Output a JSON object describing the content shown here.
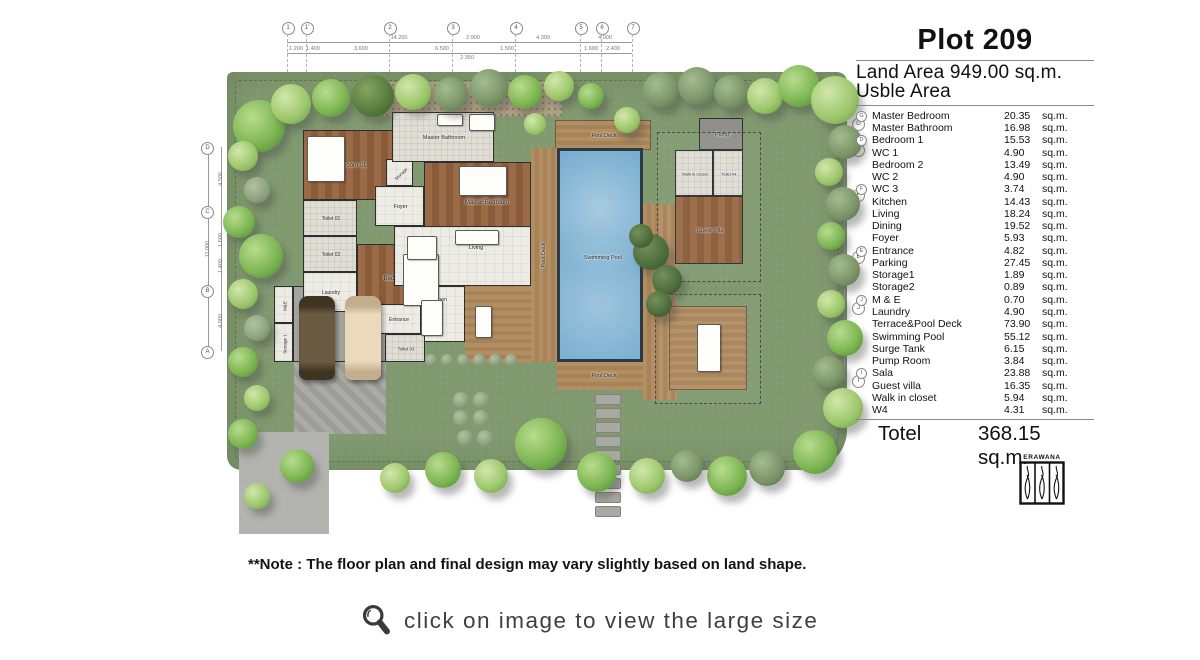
{
  "header": {
    "title": "Plot 209",
    "land_area": "Land Area 949.00 sq.m.",
    "usable_area": "Usble Area"
  },
  "table": {
    "unit": "sq.m.",
    "rows": [
      {
        "marker": "G",
        "name": "Master Bedroom",
        "value": "20.35"
      },
      {
        "name": "Master Bathroom",
        "value": "16.98"
      },
      {
        "marker": "D",
        "name": "Bedroom 1",
        "value": "15.53"
      },
      {
        "name": "WC 1",
        "value": "4.90"
      },
      {
        "name": "Bedroom 2",
        "value": "13.49"
      },
      {
        "name": "WC 2",
        "value": "4.90"
      },
      {
        "marker": "F",
        "name": "WC 3",
        "value": "3.74"
      },
      {
        "name": "Kitchen",
        "value": "14.43"
      },
      {
        "name": "Living",
        "value": "18.24"
      },
      {
        "name": "Dining",
        "value": "19.52"
      },
      {
        "name": "Foyer",
        "value": "5.93"
      },
      {
        "marker": "E",
        "name": "Entrance",
        "value": "4.82"
      },
      {
        "name": "Parking",
        "value": "27.45"
      },
      {
        "name": "Storage1",
        "value": "1.89"
      },
      {
        "name": "Storage2",
        "value": "0.89"
      },
      {
        "marker": "J",
        "name": "M & E",
        "value": "0.70"
      },
      {
        "name": "Laundry",
        "value": "4.90"
      },
      {
        "name": "Terrace&Pool Deck",
        "value": "73.90"
      },
      {
        "name": "Swimming Pool",
        "value": "55.12"
      },
      {
        "name": "Surge Tank",
        "value": "6.15"
      },
      {
        "name": "Pump Room",
        "value": "3.84"
      },
      {
        "marker": "I",
        "name": "Sala",
        "value": "23.88"
      },
      {
        "name": "Guest villa",
        "value": "16.35"
      },
      {
        "name": "Walk in closet",
        "value": "5.94"
      },
      {
        "name": "W4",
        "value": "4.31"
      }
    ]
  },
  "total": {
    "label": "Totel",
    "value": "368.15",
    "unit": "sq.m."
  },
  "logo": {
    "brand": "ERAWANA"
  },
  "note": "**Note : The floor plan and final design may vary slightly based on land shape.",
  "caption": {
    "icon": "magnifier-icon",
    "text": "click on image to view the large size"
  },
  "plan": {
    "grid": {
      "top": {
        "markers": [
          {
            "t": "1",
            "x": 88
          },
          {
            "t": "1'",
            "x": 107
          },
          {
            "t": "2",
            "x": 190
          },
          {
            "t": "3",
            "x": 253
          },
          {
            "t": "4",
            "x": 316
          },
          {
            "t": "5",
            "x": 381
          },
          {
            "t": "6",
            "x": 402
          },
          {
            "t": "7",
            "x": 433
          }
        ],
        "dims": [
          {
            "t": "14.200",
            "x": 200,
            "y": 30
          },
          {
            "t": "2.900",
            "x": 274,
            "y": 30
          },
          {
            "t": "4.300",
            "x": 344,
            "y": 30
          },
          {
            "t": "4.000",
            "x": 406,
            "y": 30
          },
          {
            "t": "1.200",
            "x": 97,
            "y": 41
          },
          {
            "t": "1.400",
            "x": 114,
            "y": 41
          },
          {
            "t": "3.600",
            "x": 162,
            "y": 41
          },
          {
            "t": "6.500",
            "x": 243,
            "y": 41
          },
          {
            "t": "1.500",
            "x": 308,
            "y": 41
          },
          {
            "t": "1.600",
            "x": 392,
            "y": 41
          },
          {
            "t": "2.400",
            "x": 414,
            "y": 41
          },
          {
            "t": "2.350",
            "x": 268,
            "y": 50
          }
        ]
      },
      "left": {
        "markers": [
          {
            "t": "D",
            "y": 139
          },
          {
            "t": "C",
            "y": 203
          },
          {
            "t": "B",
            "y": 282
          },
          {
            "t": "A",
            "y": 343
          }
        ],
        "dims": [
          {
            "t": "4.500",
            "x": 22,
            "y": 171,
            "r": -90
          },
          {
            "t": "1.600",
            "x": 22,
            "y": 232,
            "r": -90
          },
          {
            "t": "1.400",
            "x": 22,
            "y": 258,
            "r": -90
          },
          {
            "t": "4.000",
            "x": 22,
            "y": 313,
            "r": -90
          },
          {
            "t": "11.000",
            "x": 9,
            "y": 241,
            "r": -90
          }
        ]
      },
      "right": {
        "markers": [
          {
            "t": "G",
            "y": 115
          },
          {
            "t": "D",
            "y": 141
          },
          {
            "t": "F",
            "y": 186
          },
          {
            "t": "E",
            "y": 248
          },
          {
            "t": "J",
            "y": 299
          },
          {
            "t": "I",
            "y": 372
          }
        ],
        "dims": [
          {
            "t": "1.710",
            "x": 645,
            "y": 128,
            "r": -90
          },
          {
            "t": "2.900",
            "x": 645,
            "y": 163,
            "r": -90
          },
          {
            "t": "4.700",
            "x": 645,
            "y": 215,
            "r": -90
          },
          {
            "t": "3.100",
            "x": 645,
            "y": 273,
            "r": -90
          },
          {
            "t": "5.000",
            "x": 645,
            "y": 336,
            "r": -90
          }
        ]
      }
    },
    "rooms": [
      {
        "n": "gravel-court",
        "f": "gravel",
        "x": 185,
        "y": 74,
        "w": 178,
        "h": 34
      },
      {
        "n": "drive-upper",
        "f": "driveh",
        "x": 95,
        "y": 352,
        "w": 92,
        "h": 74
      },
      {
        "n": "drive-lower",
        "f": "drive",
        "x": 40,
        "y": 424,
        "w": 90,
        "h": 102
      },
      {
        "n": "terrace",
        "f": "deckh",
        "x": 266,
        "y": 278,
        "w": 66,
        "h": 77
      },
      {
        "n": "carpark",
        "f": "gray",
        "x": 94,
        "y": 278,
        "w": 98,
        "h": 76,
        "label": "Car Park",
        "wall": 1,
        "lx": 49,
        "ly": 11,
        "fs": 6
      },
      {
        "n": "mne",
        "f": "tile",
        "x": 75,
        "y": 278,
        "w": 19,
        "h": 37,
        "label": "M&E",
        "wall": 1,
        "rot": -90,
        "fs": 4.5
      },
      {
        "n": "storage-1",
        "f": "tile",
        "x": 75,
        "y": 315,
        "w": 19,
        "h": 39,
        "label": "Storage 1",
        "wall": 1,
        "rot": -90,
        "fs": 4.5
      },
      {
        "n": "bedroom-01",
        "f": "wood",
        "x": 104,
        "y": 122,
        "w": 92,
        "h": 70,
        "label": "Bedroom 01",
        "wall": 1
      },
      {
        "n": "toilet-01",
        "f": "bath",
        "x": 104,
        "y": 192,
        "w": 54,
        "h": 36,
        "label": "Toilet 01",
        "wall": 1,
        "fs": 5
      },
      {
        "n": "toilet-02",
        "f": "bath",
        "x": 104,
        "y": 228,
        "w": 54,
        "h": 36,
        "label": "Toilet 02",
        "wall": 1,
        "fs": 5
      },
      {
        "n": "laundry",
        "f": "tile",
        "x": 104,
        "y": 264,
        "w": 54,
        "h": 40,
        "label": "Laundry",
        "wall": 1,
        "fs": 5
      },
      {
        "n": "bedroom-02",
        "f": "wood",
        "x": 158,
        "y": 236,
        "w": 84,
        "h": 68,
        "label": "Bedroom 02",
        "wall": 1
      },
      {
        "n": "foyer",
        "f": "tile",
        "x": 176,
        "y": 178,
        "w": 49,
        "h": 40,
        "label": "Foyer",
        "wall": 1,
        "fs": 5.5
      },
      {
        "n": "storage-sm",
        "f": "tile",
        "x": 187,
        "y": 151,
        "w": 27,
        "h": 27,
        "label": "Storage",
        "wall": 1,
        "rot": -45,
        "fs": 4.5
      },
      {
        "n": "master-bathroom",
        "f": "bath",
        "x": 193,
        "y": 104,
        "w": 102,
        "h": 50,
        "label": "Master Bathroom",
        "wall": 1,
        "fs": 5.5
      },
      {
        "n": "master-bedroom",
        "f": "wood",
        "x": 225,
        "y": 154,
        "w": 107,
        "h": 92,
        "label": "Master Bedroom",
        "wall": 1,
        "lx": 62,
        "ly": 40
      },
      {
        "n": "living-dining-hall",
        "f": "tile",
        "x": 195,
        "y": 218,
        "w": 137,
        "h": 60,
        "wall": 1
      },
      {
        "n": "kitchen",
        "f": "tile",
        "x": 210,
        "y": 278,
        "w": 56,
        "h": 56,
        "label": "Kitchen",
        "wall": 1,
        "fs": 5.5,
        "ly": 13
      },
      {
        "n": "entrance",
        "f": "tile",
        "x": 176,
        "y": 296,
        "w": 46,
        "h": 30,
        "label": "Entrance",
        "wall": 1,
        "fs": 5
      },
      {
        "n": "toilet-03",
        "f": "bath",
        "x": 186,
        "y": 326,
        "w": 40,
        "h": 28,
        "label": "Toilet 03",
        "wall": 1,
        "fs": 4.5
      },
      {
        "n": "pool-deck-top",
        "f": "deckh",
        "x": 356,
        "y": 112,
        "w": 96,
        "h": 30,
        "label": "Pool Deck",
        "fs": 5.5,
        "border": 1
      },
      {
        "n": "pool-deck-left",
        "f": "deckv",
        "x": 332,
        "y": 140,
        "w": 26,
        "h": 214,
        "label": "Pool Deck",
        "rot": -90,
        "fs": 5.5
      },
      {
        "n": "swimming-pool",
        "f": "pool",
        "x": 358,
        "y": 140,
        "w": 86,
        "h": 214,
        "label": "Swimming Pool",
        "fs": 5.5
      },
      {
        "n": "pool-deck-bottom",
        "f": "deckh",
        "x": 358,
        "y": 354,
        "w": 94,
        "h": 28,
        "label": "Pool Deck",
        "fs": 5.5
      },
      {
        "n": "pool-deck-right",
        "f": "deckv",
        "x": 444,
        "y": 196,
        "w": 34,
        "h": 196,
        "label": "Pool Deck",
        "rot": -90,
        "fs": 5.5
      },
      {
        "n": "pump-room",
        "f": "gray2",
        "x": 500,
        "y": 110,
        "w": 44,
        "h": 32,
        "label": "Pump",
        "wall": 1,
        "fs": 5.5
      },
      {
        "n": "walk-in-closet",
        "f": "bath",
        "x": 476,
        "y": 142,
        "w": 38,
        "h": 46,
        "label": "Walk in Closet",
        "wall": 1,
        "fs": 4
      },
      {
        "n": "toilet-04",
        "f": "bath",
        "x": 514,
        "y": 142,
        "w": 30,
        "h": 46,
        "label": "Toilet 04",
        "wall": 1,
        "fs": 4
      },
      {
        "n": "guest-villa",
        "f": "wood",
        "x": 476,
        "y": 188,
        "w": 68,
        "h": 68,
        "label": "Guest Villa",
        "wall": 1,
        "fs": 5.5
      },
      {
        "n": "sala",
        "f": "deckh",
        "x": 470,
        "y": 298,
        "w": 78,
        "h": 84,
        "label": "Sala",
        "fs": 5.5,
        "ly": 56,
        "border": 1
      }
    ],
    "free_labels": [
      {
        "t": "Dining",
        "x": 222,
        "y": 240
      },
      {
        "t": "Living",
        "x": 277,
        "y": 240
      }
    ],
    "roofs": [
      {
        "x": 458,
        "y": 124,
        "w": 102,
        "h": 148
      },
      {
        "x": 456,
        "y": 286,
        "w": 104,
        "h": 108
      }
    ],
    "furniture": [
      {
        "x": 108,
        "y": 128,
        "w": 36,
        "h": 44
      },
      {
        "x": 204,
        "y": 246,
        "w": 34,
        "h": 50
      },
      {
        "x": 260,
        "y": 158,
        "w": 46,
        "h": 28
      },
      {
        "x": 208,
        "y": 228,
        "w": 28,
        "h": 22
      },
      {
        "x": 256,
        "y": 222,
        "w": 42,
        "h": 13
      },
      {
        "x": 222,
        "y": 292,
        "w": 20,
        "h": 34
      },
      {
        "x": 270,
        "y": 106,
        "w": 24,
        "h": 15
      },
      {
        "x": 498,
        "y": 316,
        "w": 22,
        "h": 46
      },
      {
        "x": 276,
        "y": 298,
        "w": 15,
        "h": 30
      },
      {
        "x": 238,
        "y": 106,
        "w": 24,
        "h": 10
      }
    ],
    "cars": [
      {
        "x": 100,
        "y": 288,
        "c1": "#6a5a42",
        "c2": "#3f3422"
      },
      {
        "x": 146,
        "y": 288,
        "c1": "#ead9bc",
        "c2": "#c2ae8c"
      }
    ],
    "stones": {
      "x": 396,
      "y": 386,
      "w": 24,
      "h": 9,
      "gap": 14,
      "count": 9
    },
    "trees": [
      {
        "x": 60,
        "y": 118,
        "r": 26,
        "t": "c1"
      },
      {
        "x": 92,
        "y": 96,
        "r": 20,
        "t": "c2"
      },
      {
        "x": 132,
        "y": 90,
        "r": 19,
        "t": "c1"
      },
      {
        "x": 174,
        "y": 88,
        "r": 21,
        "t": "dark"
      },
      {
        "x": 214,
        "y": 84,
        "r": 18,
        "t": "c2"
      },
      {
        "x": 252,
        "y": 86,
        "r": 17,
        "t": "fern"
      },
      {
        "x": 290,
        "y": 80,
        "r": 19,
        "t": "fern"
      },
      {
        "x": 326,
        "y": 84,
        "r": 17,
        "t": "c1"
      },
      {
        "x": 360,
        "y": 78,
        "r": 15,
        "t": "c2"
      },
      {
        "x": 392,
        "y": 88,
        "r": 13,
        "t": "c1"
      },
      {
        "x": 428,
        "y": 112,
        "r": 13,
        "t": "c2"
      },
      {
        "x": 462,
        "y": 82,
        "r": 18,
        "t": "fern"
      },
      {
        "x": 498,
        "y": 78,
        "r": 19,
        "t": "fern"
      },
      {
        "x": 532,
        "y": 84,
        "r": 17,
        "t": "fern"
      },
      {
        "x": 566,
        "y": 88,
        "r": 18,
        "t": "c2"
      },
      {
        "x": 600,
        "y": 78,
        "r": 21,
        "t": "c1"
      },
      {
        "x": 636,
        "y": 92,
        "r": 24,
        "t": "c2"
      },
      {
        "x": 646,
        "y": 134,
        "r": 17,
        "t": "fern"
      },
      {
        "x": 630,
        "y": 164,
        "r": 14,
        "t": "c2"
      },
      {
        "x": 644,
        "y": 196,
        "r": 17,
        "t": "fern"
      },
      {
        "x": 632,
        "y": 228,
        "r": 14,
        "t": "c1"
      },
      {
        "x": 645,
        "y": 262,
        "r": 16,
        "t": "fern"
      },
      {
        "x": 632,
        "y": 296,
        "r": 14,
        "t": "c2"
      },
      {
        "x": 646,
        "y": 330,
        "r": 18,
        "t": "c1"
      },
      {
        "x": 630,
        "y": 364,
        "r": 16,
        "t": "fern"
      },
      {
        "x": 644,
        "y": 400,
        "r": 20,
        "t": "c2"
      },
      {
        "x": 616,
        "y": 444,
        "r": 22,
        "t": "c1"
      },
      {
        "x": 568,
        "y": 460,
        "r": 18,
        "t": "fern"
      },
      {
        "x": 528,
        "y": 468,
        "r": 20,
        "t": "c1"
      },
      {
        "x": 488,
        "y": 458,
        "r": 16,
        "t": "fern"
      },
      {
        "x": 448,
        "y": 468,
        "r": 18,
        "t": "c2"
      },
      {
        "x": 398,
        "y": 464,
        "r": 20,
        "t": "c1"
      },
      {
        "x": 342,
        "y": 436,
        "r": 26,
        "t": "c1"
      },
      {
        "x": 292,
        "y": 468,
        "r": 17,
        "t": "c2"
      },
      {
        "x": 244,
        "y": 462,
        "r": 18,
        "t": "c1"
      },
      {
        "x": 196,
        "y": 470,
        "r": 15,
        "t": "c2"
      },
      {
        "x": 98,
        "y": 458,
        "r": 17,
        "t": "c1"
      },
      {
        "x": 58,
        "y": 488,
        "r": 13,
        "t": "c2"
      },
      {
        "x": 44,
        "y": 148,
        "r": 15,
        "t": "c2"
      },
      {
        "x": 58,
        "y": 182,
        "r": 13,
        "t": "shr"
      },
      {
        "x": 40,
        "y": 214,
        "r": 16,
        "t": "c1"
      },
      {
        "x": 62,
        "y": 248,
        "r": 22,
        "t": "c1"
      },
      {
        "x": 44,
        "y": 286,
        "r": 15,
        "t": "c2"
      },
      {
        "x": 58,
        "y": 320,
        "r": 13,
        "t": "shr"
      },
      {
        "x": 44,
        "y": 354,
        "r": 15,
        "t": "c1"
      },
      {
        "x": 58,
        "y": 390,
        "r": 13,
        "t": "c2"
      },
      {
        "x": 44,
        "y": 426,
        "r": 15,
        "t": "c1"
      },
      {
        "x": 452,
        "y": 244,
        "r": 18,
        "t": "palm"
      },
      {
        "x": 468,
        "y": 272,
        "r": 15,
        "t": "palm"
      },
      {
        "x": 442,
        "y": 228,
        "r": 12,
        "t": "palm"
      },
      {
        "x": 460,
        "y": 296,
        "r": 13,
        "t": "palm"
      },
      {
        "x": 336,
        "y": 116,
        "r": 11,
        "t": "c2"
      },
      {
        "x": 262,
        "y": 392,
        "r": 8,
        "t": "shr"
      },
      {
        "x": 282,
        "y": 392,
        "r": 8,
        "t": "shr"
      },
      {
        "x": 262,
        "y": 410,
        "r": 8,
        "t": "shr"
      },
      {
        "x": 282,
        "y": 410,
        "r": 8,
        "t": "shr"
      },
      {
        "x": 266,
        "y": 430,
        "r": 8,
        "t": "shr"
      },
      {
        "x": 286,
        "y": 430,
        "r": 8,
        "t": "shr"
      },
      {
        "x": 232,
        "y": 352,
        "r": 6,
        "t": "shr"
      },
      {
        "x": 248,
        "y": 352,
        "r": 6,
        "t": "shr"
      },
      {
        "x": 264,
        "y": 352,
        "r": 6,
        "t": "shr"
      },
      {
        "x": 280,
        "y": 352,
        "r": 6,
        "t": "shr"
      },
      {
        "x": 296,
        "y": 352,
        "r": 6,
        "t": "shr"
      },
      {
        "x": 312,
        "y": 352,
        "r": 6,
        "t": "shr"
      }
    ]
  }
}
